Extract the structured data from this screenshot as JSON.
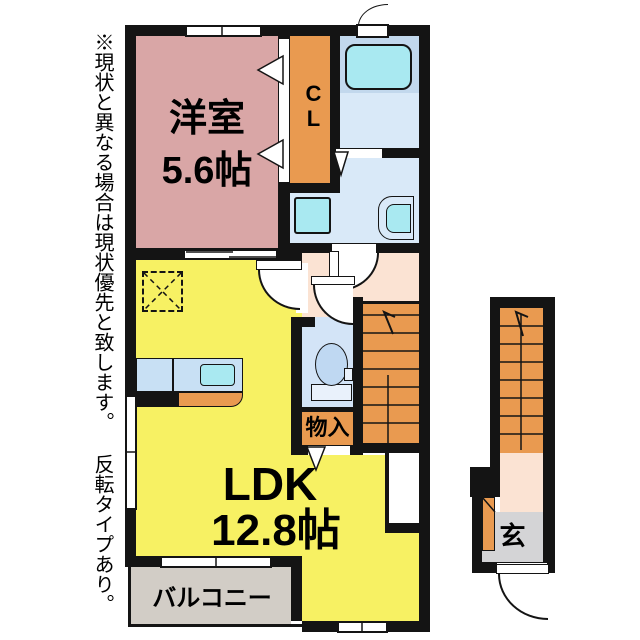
{
  "note": {
    "text": "※現状と異なる場合は現状優先と致します。 反転タイプあり。"
  },
  "plan2f": {
    "western_room": {
      "name": "洋室",
      "size": "5.6帖"
    },
    "closet": {
      "label": "CL"
    },
    "ldk": {
      "name": "LDK",
      "size": "12.8帖"
    },
    "storage": {
      "label": "物入"
    },
    "balcony": {
      "label": "バルコニー"
    }
  },
  "plan1f": {
    "entrance": {
      "label": "玄"
    }
  },
  "palette": {
    "wall": "#141414",
    "western_room_pink": "#d9a6a6",
    "wood_orange": "#e99a50",
    "ldk_yellow": "#f7f163",
    "hall_peach": "#fbe3d3",
    "bath_blue": "#c2d8ed",
    "washroom_blue": "#d9e9f8",
    "fixture_cyan": "#a9e9f1",
    "toilet_blue": "#d3e4f7",
    "entrance_grey": "#d4d4d6",
    "balcony_grey": "#d2cdc6",
    "counter_blue": "#c8e0f4"
  }
}
